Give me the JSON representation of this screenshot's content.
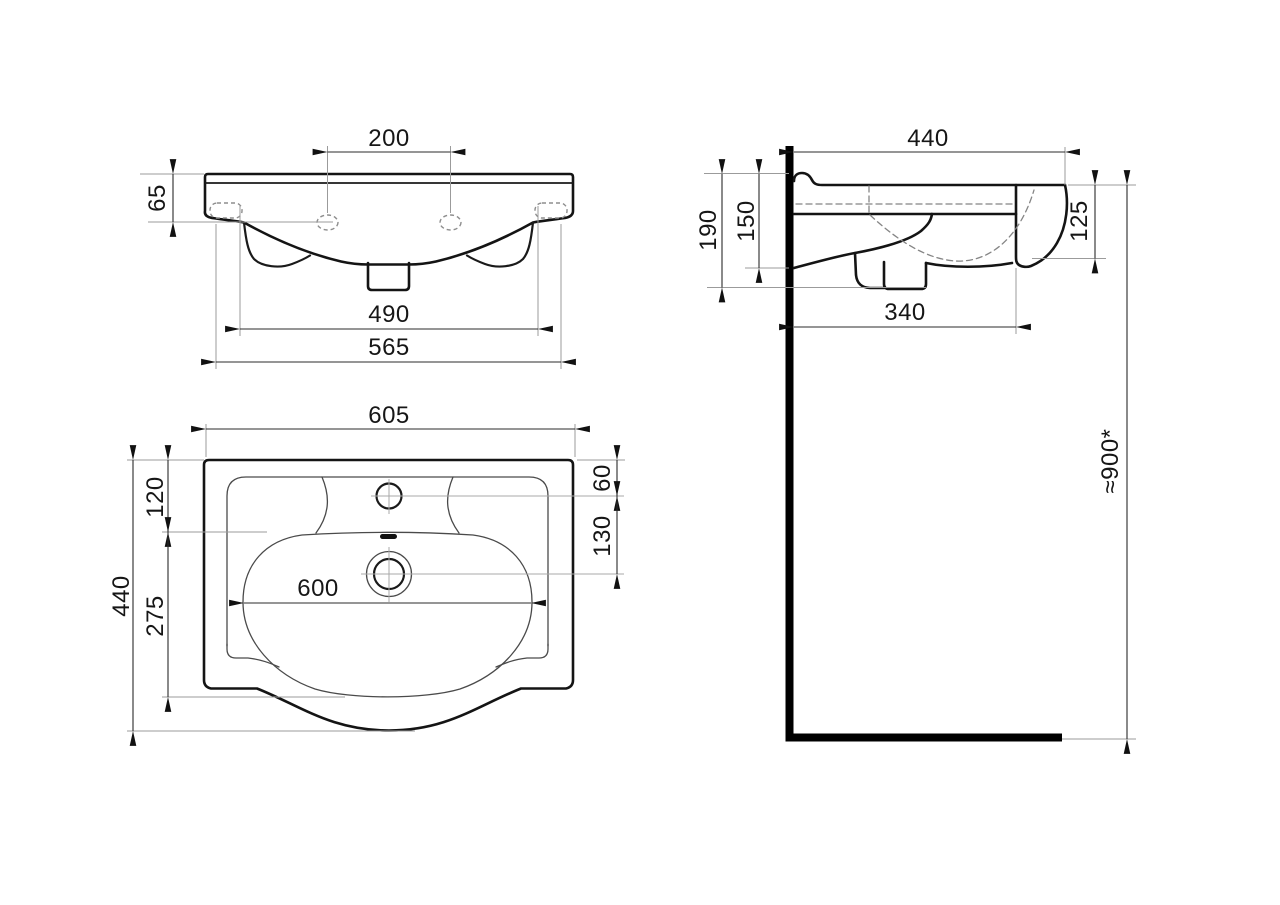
{
  "drawing": {
    "dimensions": {
      "front": {
        "tap_hole_spacing": "200",
        "rim_height": "65",
        "fixing_hole_spacing": "490",
        "body_width": "565"
      },
      "side": {
        "overall_depth": "440",
        "wall_to_outlet_bottom": "190",
        "wall_to_bowl_underside": "150",
        "front_edge_height": "125",
        "wall_to_outlet": "340",
        "installation_height": "≈900*"
      },
      "plan": {
        "overall_width": "605",
        "rear_to_deck": "120",
        "overall_depth": "440",
        "deck_to_bowl_front": "275",
        "tap_hole_offset": "60",
        "tap_to_drain": "130",
        "bowl_width": "600"
      }
    }
  }
}
